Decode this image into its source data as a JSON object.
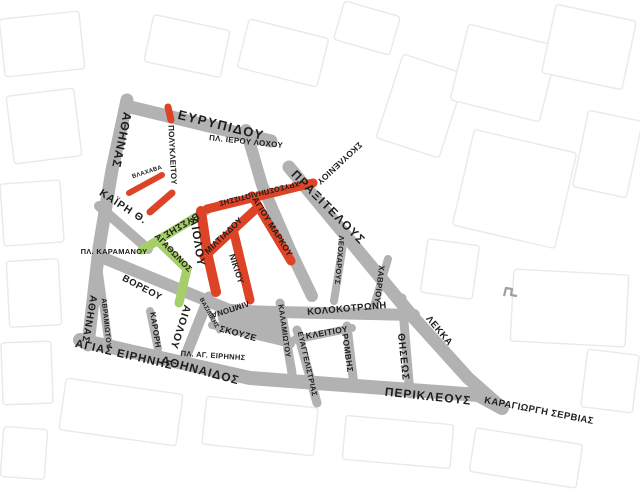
{
  "map": {
    "canvas": {
      "width": 640,
      "height": 494,
      "background": "#ffffff"
    },
    "colors": {
      "street_gray": "#b2b2b2",
      "pedestrian_red": "#dd4327",
      "pedestrian_green": "#a6cf6a",
      "basemap_line": "#e9e9e9",
      "basemap_line_dark": "#9f9f9f",
      "label": "#1d1d1b"
    },
    "basemap_blocks": [
      {
        "x": 2,
        "y": 15,
        "w": 80,
        "h": 58,
        "r": -6
      },
      {
        "x": 10,
        "y": 92,
        "w": 68,
        "h": 68,
        "r": -7
      },
      {
        "x": 2,
        "y": 182,
        "w": 60,
        "h": 62,
        "r": -4
      },
      {
        "x": 8,
        "y": 260,
        "w": 52,
        "h": 66,
        "r": -3
      },
      {
        "x": 2,
        "y": 342,
        "w": 50,
        "h": 62,
        "r": -2
      },
      {
        "x": 148,
        "y": 22,
        "w": 78,
        "h": 48,
        "r": 12
      },
      {
        "x": 242,
        "y": 28,
        "w": 82,
        "h": 50,
        "r": 14
      },
      {
        "x": 338,
        "y": 8,
        "w": 58,
        "h": 40,
        "r": 16
      },
      {
        "x": 388,
        "y": 62,
        "w": 66,
        "h": 88,
        "r": 18
      },
      {
        "x": 458,
        "y": 34,
        "w": 92,
        "h": 78,
        "r": 14
      },
      {
        "x": 548,
        "y": 12,
        "w": 82,
        "h": 70,
        "r": 12
      },
      {
        "x": 462,
        "y": 140,
        "w": 105,
        "h": 98,
        "r": 13
      },
      {
        "x": 580,
        "y": 115,
        "w": 55,
        "h": 78,
        "r": 12
      },
      {
        "x": 424,
        "y": 242,
        "w": 52,
        "h": 54,
        "r": 8
      },
      {
        "x": 512,
        "y": 272,
        "w": 115,
        "h": 72,
        "r": 3
      },
      {
        "x": 584,
        "y": 352,
        "w": 52,
        "h": 58,
        "r": 7
      },
      {
        "x": 62,
        "y": 386,
        "w": 118,
        "h": 52,
        "r": 8
      },
      {
        "x": 204,
        "y": 402,
        "w": 112,
        "h": 48,
        "r": 6
      },
      {
        "x": 344,
        "y": 420,
        "w": 108,
        "h": 44,
        "r": 5
      },
      {
        "x": 472,
        "y": 436,
        "w": 108,
        "h": 44,
        "r": 9
      },
      {
        "x": 2,
        "y": 428,
        "w": 44,
        "h": 50,
        "r": 4
      }
    ],
    "building_mark": {
      "points": [
        [
          504,
          296
        ],
        [
          506,
          288
        ],
        [
          512,
          289
        ],
        [
          511,
          295
        ],
        [
          517,
          296
        ]
      ]
    },
    "plazas": [
      {
        "name": "agia-irini-block",
        "points": [
          [
            214,
            303
          ],
          [
            284,
            307
          ],
          [
            292,
            344
          ],
          [
            221,
            330
          ]
        ]
      }
    ],
    "streets": [
      {
        "name": "athinas",
        "color": "gray",
        "width": 13,
        "points": [
          [
            127,
            100
          ],
          [
            112,
            170
          ],
          [
            99,
            248
          ],
          [
            88,
            345
          ]
        ]
      },
      {
        "name": "evripidou",
        "color": "gray",
        "width": 13,
        "points": [
          [
            126,
            106
          ],
          [
            271,
            141
          ]
        ]
      },
      {
        "name": "ierou-lochou-link",
        "color": "gray",
        "width": 12,
        "points": [
          [
            246,
            130
          ],
          [
            262,
            185
          ],
          [
            291,
            252
          ],
          [
            312,
            296
          ]
        ]
      },
      {
        "name": "praxitelous",
        "color": "gray",
        "width": 13,
        "points": [
          [
            289,
            167
          ],
          [
            413,
            317
          ]
        ]
      },
      {
        "name": "lekka",
        "color": "gray",
        "width": 13,
        "points": [
          [
            413,
            317
          ],
          [
            468,
            378
          ],
          [
            502,
            408
          ]
        ]
      },
      {
        "name": "voreou-kolokotroni-band",
        "color": "gray",
        "width": 12,
        "points": [
          [
            101,
            257
          ],
          [
            232,
            311
          ],
          [
            414,
            315
          ]
        ]
      },
      {
        "name": "kairi",
        "color": "gray",
        "width": 10,
        "points": [
          [
            99,
            206
          ],
          [
            148,
            249
          ]
        ]
      },
      {
        "name": "aiolou-lower",
        "color": "gray",
        "width": 11,
        "points": [
          [
            209,
            297
          ],
          [
            184,
            360
          ]
        ]
      },
      {
        "name": "skouze",
        "color": "gray",
        "width": 8,
        "points": [
          [
            212,
            325
          ],
          [
            291,
            344
          ]
        ]
      },
      {
        "name": "vasilikis",
        "color": "gray",
        "width": 5,
        "points": [
          [
            201,
            297
          ],
          [
            219,
            331
          ]
        ]
      },
      {
        "name": "karori",
        "color": "gray",
        "width": 8,
        "points": [
          [
            150,
            311
          ],
          [
            158,
            349
          ]
        ]
      },
      {
        "name": "avramiotou",
        "color": "gray",
        "width": 8,
        "points": [
          [
            98,
            266
          ],
          [
            109,
            347
          ]
        ]
      },
      {
        "name": "kalamiotou",
        "color": "gray",
        "width": 9,
        "points": [
          [
            280,
            303
          ],
          [
            292,
            373
          ]
        ]
      },
      {
        "name": "evangelistrias",
        "color": "gray",
        "width": 9,
        "points": [
          [
            297,
            330
          ],
          [
            317,
            403
          ]
        ]
      },
      {
        "name": "kleitiou",
        "color": "gray",
        "width": 8,
        "points": [
          [
            294,
            340
          ],
          [
            352,
            328
          ]
        ]
      },
      {
        "name": "romvis",
        "color": "gray",
        "width": 9,
        "points": [
          [
            347,
            326
          ],
          [
            354,
            386
          ]
        ]
      },
      {
        "name": "thiseos",
        "color": "gray",
        "width": 9,
        "points": [
          [
            402,
            298
          ],
          [
            410,
            394
          ]
        ]
      },
      {
        "name": "chavriou",
        "color": "gray",
        "width": 8,
        "points": [
          [
            388,
            259
          ],
          [
            374,
            306
          ]
        ]
      },
      {
        "name": "leocharous",
        "color": "gray",
        "width": 8,
        "points": [
          [
            344,
            238
          ],
          [
            334,
            301
          ]
        ]
      },
      {
        "name": "agias-irinis-band",
        "color": "gray",
        "width": 14,
        "points": [
          [
            80,
            340
          ],
          [
            250,
            378
          ],
          [
            478,
            395
          ],
          [
            502,
            408
          ]
        ]
      },
      {
        "name": "polykleitou-upper",
        "color": "red",
        "width": 7,
        "points": [
          [
            168,
            107
          ],
          [
            171,
            120
          ]
        ]
      },
      {
        "name": "polykleitou-lower",
        "color": "red",
        "width": 7,
        "points": [
          [
            172,
            193
          ],
          [
            150,
            212
          ]
        ]
      },
      {
        "name": "vlachava",
        "color": "red",
        "width": 6,
        "points": [
          [
            129,
            193
          ],
          [
            162,
            175
          ]
        ]
      },
      {
        "name": "chrysospiliotissis",
        "color": "red",
        "width": 9,
        "points": [
          [
            207,
            209
          ],
          [
            313,
            183
          ]
        ]
      },
      {
        "name": "agiou-markou",
        "color": "red",
        "width": 9,
        "points": [
          [
            252,
            196
          ],
          [
            291,
            261
          ]
        ]
      },
      {
        "name": "aiolou-pedestrian",
        "color": "red",
        "width": 10,
        "points": [
          [
            201,
            211
          ],
          [
            207,
            252
          ],
          [
            216,
            292
          ]
        ]
      },
      {
        "name": "miltiadou",
        "color": "red",
        "width": 9,
        "points": [
          [
            204,
            257
          ],
          [
            258,
            207
          ]
        ]
      },
      {
        "name": "nikiou",
        "color": "red",
        "width": 9,
        "points": [
          [
            233,
            229
          ],
          [
            250,
            300
          ]
        ]
      },
      {
        "name": "vyssis",
        "color": "green",
        "width": 9,
        "points": [
          [
            206,
            211
          ],
          [
            142,
            250
          ]
        ]
      },
      {
        "name": "agathonos",
        "color": "green",
        "width": 9,
        "points": [
          [
            160,
            243
          ],
          [
            187,
            269
          ],
          [
            179,
            303
          ]
        ]
      }
    ],
    "labels": [
      {
        "name": "evripidou",
        "text": "ΕΥΡΥΠΙΔΟΥ",
        "x": 221,
        "y": 126,
        "rotate": 14,
        "size": 13,
        "spacing": 1.5
      },
      {
        "name": "pl-ierou-lochou",
        "text": "ΠΛ. ΙΕΡΟΥ ΛΟΧΟΥ",
        "x": 246,
        "y": 142,
        "rotate": 6,
        "size": 8,
        "spacing": 0.3
      },
      {
        "name": "athinas-north",
        "text": "ΑΘΗΝΑΣ",
        "x": 121,
        "y": 140,
        "rotate": 102,
        "size": 12,
        "spacing": 1
      },
      {
        "name": "athinas-south",
        "text": "ΑΘΗΝΑΣ",
        "x": 89,
        "y": 319,
        "rotate": 100,
        "size": 10,
        "spacing": 1
      },
      {
        "name": "polykleitou",
        "text": "ΠΟΛΥΚΛΕΙΤΟΥ",
        "x": 172,
        "y": 155,
        "rotate": 87,
        "size": 8,
        "spacing": 0.3,
        "color": "pedestrian_red"
      },
      {
        "name": "vlachava",
        "text": "ΒΛΑΧΑΒΑ",
        "x": 147,
        "y": 172,
        "rotate": -18,
        "size": 6,
        "spacing": 0.2
      },
      {
        "name": "kairi",
        "text": "ΚΑΪΡΗ Θ.",
        "x": 123,
        "y": 207,
        "rotate": 33,
        "size": 10.5,
        "spacing": 1
      },
      {
        "name": "skouleniou",
        "text": "ΣΚΟΥΛΕΝΙΟΥ",
        "x": 339,
        "y": 163,
        "rotate": 137,
        "size": 8.5,
        "spacing": 0.4
      },
      {
        "name": "praxitelous",
        "text": "ΠΡΑΞΙΤΕΛΟΥΣ",
        "x": 328,
        "y": 208,
        "rotate": 45,
        "size": 12,
        "spacing": 1.5
      },
      {
        "name": "chrysospiliotissis",
        "text": "ΧΡΥΣΟΣΠΗΛΙΩΤΙΣΣΗΣ",
        "x": 259,
        "y": 193,
        "rotate": 166,
        "size": 7.5,
        "spacing": 0.2
      },
      {
        "name": "vyssis",
        "text": "ΒΥΣΣΗΣ",
        "x": 181,
        "y": 225,
        "rotate": 149,
        "size": 9.5,
        "spacing": 0.4
      },
      {
        "name": "agiou-markou",
        "text": "ΑΓΙΟΥ ΜΑΡΚΟΥ",
        "x": 272,
        "y": 227,
        "rotate": 58,
        "size": 8.5,
        "spacing": 0.3
      },
      {
        "name": "miltiadou",
        "text": "ΜΙΛΤΙΑΔΟΥ",
        "x": 224,
        "y": 236,
        "rotate": -44,
        "size": 8.5,
        "spacing": 0.3
      },
      {
        "name": "nikiou",
        "text": "ΝΙΚΙΟΥ",
        "x": 236,
        "y": 269,
        "rotate": 72,
        "size": 8.5,
        "spacing": 0.3
      },
      {
        "name": "aiolou-pedestrian",
        "text": "ΑΙΟΛΟΥ",
        "x": 197,
        "y": 242,
        "rotate": 81,
        "size": 11.5,
        "spacing": 1
      },
      {
        "name": "agathonos",
        "text": "ΑΓΑΘΩΝΟΣ",
        "x": 173,
        "y": 253,
        "rotate": 46,
        "size": 8.5,
        "spacing": 0.3
      },
      {
        "name": "pl-karamanou",
        "text": "ΠΛ. ΚΑΡΑΜΑΝΟΥ",
        "x": 114,
        "y": 252,
        "rotate": 0,
        "size": 7.5,
        "spacing": 0.3
      },
      {
        "name": "voreou",
        "text": "ΒΟΡΕΟΥ",
        "x": 142,
        "y": 288,
        "rotate": 28,
        "size": 9.5,
        "spacing": 0.5
      },
      {
        "name": "avramiotou",
        "text": "ΑΒΡΑΜΙΩΤΟΥ",
        "x": 106,
        "y": 323,
        "rotate": 84,
        "size": 7,
        "spacing": 0.3
      },
      {
        "name": "karori",
        "text": "ΚΑΡΟΡΗ",
        "x": 155,
        "y": 330,
        "rotate": 81,
        "size": 8,
        "spacing": 0.3
      },
      {
        "name": "aiolou-lower",
        "text": "ΑΙΟΛΟΥ",
        "x": 180,
        "y": 327,
        "rotate": 108,
        "size": 10.5,
        "spacing": 1
      },
      {
        "name": "vasilikis",
        "text": "ΒΑΣΙΛΙΚΗΣ",
        "x": 209,
        "y": 313,
        "rotate": 61,
        "size": 6,
        "spacing": 0.2
      },
      {
        "name": "limpona",
        "text": "ΛΙΜΠΟΝΑ",
        "x": 230,
        "y": 309,
        "rotate": 162,
        "size": 8,
        "spacing": 0.3
      },
      {
        "name": "skouze",
        "text": "ΣΚΟΥΖΕ",
        "x": 238,
        "y": 334,
        "rotate": 15,
        "size": 9,
        "spacing": 0.4
      },
      {
        "name": "pl-ag-irinis",
        "text": "ΠΛ. ΑΓ. ΕΙΡΗΝΗΣ",
        "x": 213,
        "y": 356,
        "rotate": 4,
        "size": 7.5,
        "spacing": 0.3
      },
      {
        "name": "agias-irinis",
        "text": "ΑΓΙΑΣ ΕΙΡΗΝΗΣ",
        "x": 124,
        "y": 355,
        "rotate": 13,
        "size": 11.5,
        "spacing": 1
      },
      {
        "name": "athinaidos",
        "text": "ΑΘΗΝΑΙΔΟΣ",
        "x": 200,
        "y": 371,
        "rotate": 15,
        "size": 12,
        "spacing": 1
      },
      {
        "name": "kalamiotou",
        "text": "ΚΑΛΑΜΙΩΤΟΥ",
        "x": 284,
        "y": 331,
        "rotate": 82,
        "size": 7.5,
        "spacing": 0.3
      },
      {
        "name": "evangelistrias",
        "text": "ΕΥΑΓΓΕΛΙΣΤΡΙΑΣ",
        "x": 307,
        "y": 364,
        "rotate": 77,
        "size": 7.5,
        "spacing": 0.3
      },
      {
        "name": "kleitiou",
        "text": "ΚΛΕΙΤΙΟΥ",
        "x": 327,
        "y": 333,
        "rotate": -10,
        "size": 8.5,
        "spacing": 0.4
      },
      {
        "name": "romvis",
        "text": "ΡΟΜΒΗΣ",
        "x": 347,
        "y": 353,
        "rotate": 82,
        "size": 8.5,
        "spacing": 0.4
      },
      {
        "name": "kolokotroni",
        "text": "ΚΟΛΟΚΟΤΡΩΝΗ",
        "x": 347,
        "y": 309,
        "rotate": -5,
        "size": 9.5,
        "spacing": 0.5
      },
      {
        "name": "chavriou",
        "text": "ΧΑΒΡΙΟΥ",
        "x": 379,
        "y": 284,
        "rotate": 97,
        "size": 8,
        "spacing": 0.3
      },
      {
        "name": "leocharous",
        "text": "ΛΕΟΧΑΡΟΥΣ",
        "x": 339,
        "y": 260,
        "rotate": 95,
        "size": 7.5,
        "spacing": 0.3
      },
      {
        "name": "lekka",
        "text": "ΛΕΚΚΑ",
        "x": 439,
        "y": 331,
        "rotate": 50,
        "size": 9.5,
        "spacing": 0.5
      },
      {
        "name": "thiseos",
        "text": "ΘΗΣΕΩΣ",
        "x": 403,
        "y": 357,
        "rotate": 84,
        "size": 10,
        "spacing": 1
      },
      {
        "name": "perikleous",
        "text": "ΠΕΡΙΚΛΕΟΥΣ",
        "x": 428,
        "y": 397,
        "rotate": 6,
        "size": 12,
        "spacing": 1
      },
      {
        "name": "karagiorgi-servias",
        "text": "ΚΑΡΑΓΙΩΡΓΗ ΣΕΡΒΙΑΣ",
        "x": 539,
        "y": 411,
        "rotate": 11,
        "size": 9.5,
        "spacing": 0.4
      }
    ]
  }
}
